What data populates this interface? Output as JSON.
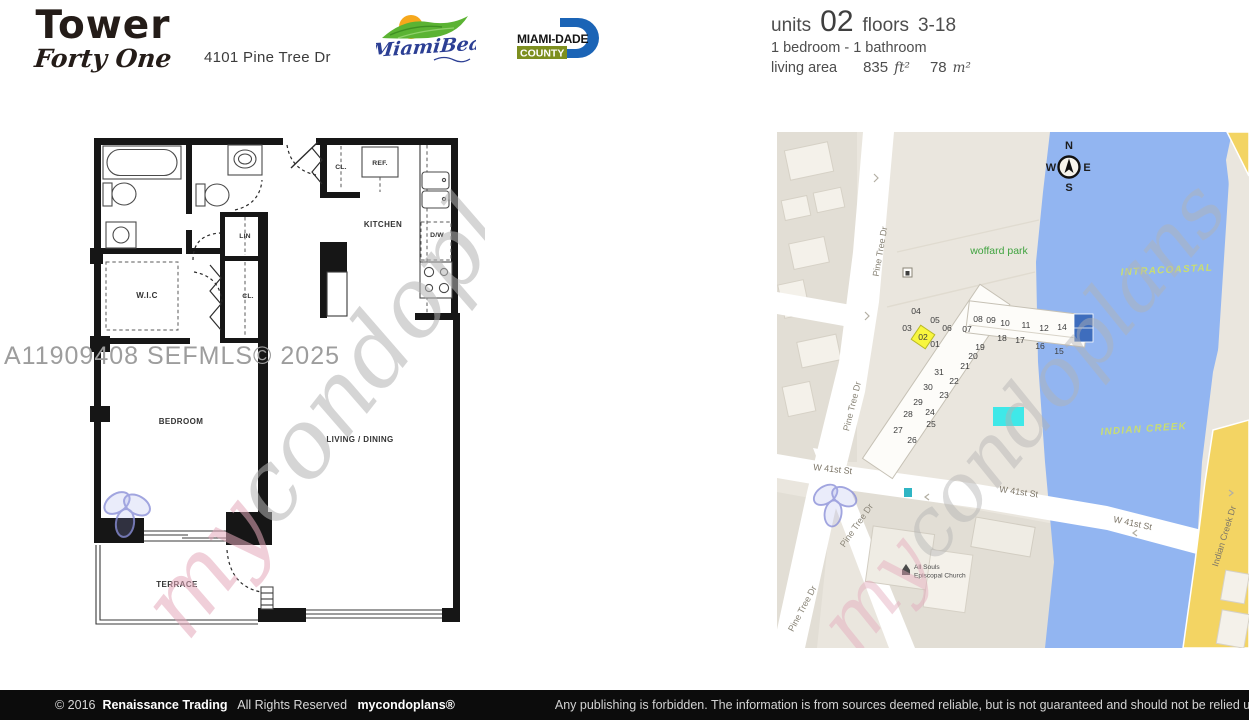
{
  "header": {
    "building_name": "Tower",
    "building_subname": "Forty One",
    "address": "4101 Pine Tree Dr",
    "miami_beach_logo_text": "MiamiBeach",
    "miami_dade_line1": "MIAMI-DADE",
    "miami_dade_line2": "COUNTY"
  },
  "unit_info": {
    "units_label": "units",
    "unit_number": "02",
    "floors_label": "floors",
    "floors_range": "3-18",
    "bed_bath": "1 bedroom - 1 bathroom",
    "living_area_label": "living area",
    "area_ft_value": "835",
    "area_ft_unit": "ft²",
    "area_m_value": "78",
    "area_m_unit": "m²"
  },
  "floorplan": {
    "mls_watermark": "A11909408  SEFMLS© 2025",
    "labels": {
      "bedroom": "BEDROOM",
      "living_dining": "LIVING / DINING",
      "terrace": "TERRACE",
      "kitchen": "KITCHEN",
      "wic": "W.I.C",
      "lin": "LIN",
      "closet_hall": "CL.",
      "closet_entry": "CL.",
      "refrigerator": "REF.",
      "dishwasher": "D/W"
    }
  },
  "brand_watermark": {
    "prefix": "my",
    "suffix": "condoplans"
  },
  "map": {
    "compass": {
      "north": "N",
      "south": "S",
      "east": "E",
      "west": "W"
    },
    "place_labels": {
      "park": "woffard park",
      "intracoastal": "INTRACOASTAL",
      "indian_creek": "INDIAN CREEK",
      "church_line1": "All Souls",
      "church_line2": "Episcopal Church"
    },
    "street_labels": {
      "pine_tree_dr": "Pine Tree Dr",
      "w_41st_st": "W 41st St",
      "indian_creek_dr": "Indian Creek Dr"
    },
    "highlighted_unit": "02",
    "units": [
      {
        "n": "04",
        "x": 139,
        "y": 182
      },
      {
        "n": "05",
        "x": 158,
        "y": 191
      },
      {
        "n": "03",
        "x": 130,
        "y": 199
      },
      {
        "n": "06",
        "x": 170,
        "y": 199
      },
      {
        "n": "02",
        "x": 146,
        "y": 208
      },
      {
        "n": "01",
        "x": 158,
        "y": 215
      },
      {
        "n": "07",
        "x": 190,
        "y": 200
      },
      {
        "n": "08",
        "x": 201,
        "y": 190
      },
      {
        "n": "09",
        "x": 214,
        "y": 191
      },
      {
        "n": "10",
        "x": 228,
        "y": 194
      },
      {
        "n": "11",
        "x": 249,
        "y": 196
      },
      {
        "n": "12",
        "x": 267,
        "y": 199
      },
      {
        "n": "14",
        "x": 285,
        "y": 198
      },
      {
        "n": "18",
        "x": 225,
        "y": 209
      },
      {
        "n": "17",
        "x": 243,
        "y": 211
      },
      {
        "n": "16",
        "x": 263,
        "y": 217
      },
      {
        "n": "15",
        "x": 282,
        "y": 222
      },
      {
        "n": "19",
        "x": 203,
        "y": 218
      },
      {
        "n": "20",
        "x": 196,
        "y": 227
      },
      {
        "n": "21",
        "x": 188,
        "y": 237
      },
      {
        "n": "31",
        "x": 162,
        "y": 243
      },
      {
        "n": "22",
        "x": 177,
        "y": 252
      },
      {
        "n": "30",
        "x": 151,
        "y": 258
      },
      {
        "n": "23",
        "x": 167,
        "y": 266
      },
      {
        "n": "29",
        "x": 141,
        "y": 273
      },
      {
        "n": "24",
        "x": 153,
        "y": 283
      },
      {
        "n": "28",
        "x": 131,
        "y": 285
      },
      {
        "n": "25",
        "x": 154,
        "y": 295
      },
      {
        "n": "27",
        "x": 121,
        "y": 301
      },
      {
        "n": "26",
        "x": 135,
        "y": 311
      }
    ]
  },
  "footer": {
    "copyright": "© 2016",
    "company": "Renaissance Trading",
    "rights": "All Rights Reserved",
    "brand": "mycondoplans®",
    "disclaimer": "Any publishing is forbidden.  The information is from sources deemed reliable, but is not guaranteed and should not be relied upon without independent verification."
  },
  "colors": {
    "map_water": "#92b5f1",
    "map_road_yellow": "#f3d463",
    "unit_highlight": "#f8f63e",
    "pool_cyan": "#3fe8e8",
    "park_label_green": "#3fa33f",
    "water_label": "#c9dd72",
    "watermark_pink": "#e4a9bb",
    "watermark_gray": "#b3b3b3"
  }
}
